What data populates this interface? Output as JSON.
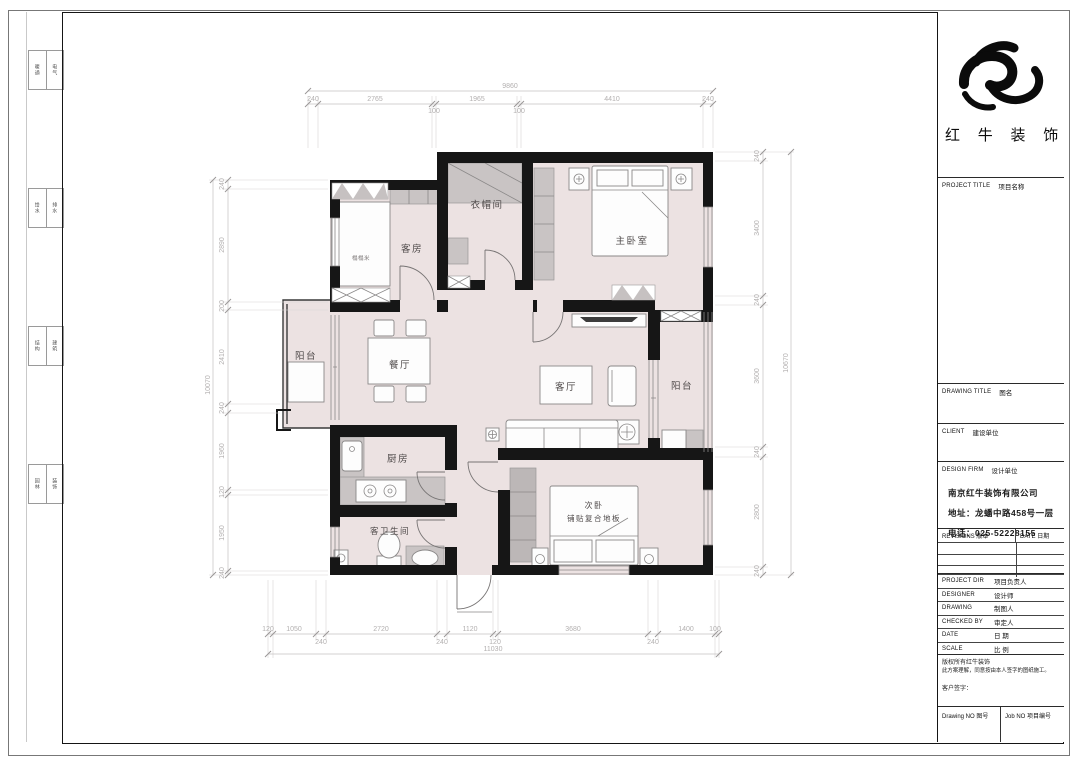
{
  "colors": {
    "wall": "#161616",
    "room_fill": "#ece2e2",
    "furniture_gray": "#c9c4c4",
    "dim_text": "#b3b0b0",
    "frame": "#151515"
  },
  "title_block": {
    "brand": "红 牛 装 饰",
    "sections": {
      "project_title": {
        "en": "PROJECT TITLE",
        "cn": "项目名称"
      },
      "drawing_title": {
        "en": "DRAWING TITLE",
        "cn": "图名"
      },
      "client": {
        "en": "CLIENT",
        "cn": "建设单位"
      },
      "design_firm": {
        "en": "DESIGN FIRM",
        "cn": "设计单位"
      }
    },
    "firm_info": [
      "南京红牛装饰有限公司",
      "地址：龙蟠中路458号一层",
      "电话：025-52228155"
    ],
    "revisions": {
      "left": "REVISIONS 版本",
      "right": "DATE 日期"
    },
    "staff": [
      {
        "en": "PROJECT DIR",
        "cn": "项目负责人"
      },
      {
        "en": "DESIGNER",
        "cn": "设计师"
      },
      {
        "en": "DRAWING",
        "cn": "制图人"
      },
      {
        "en": "CHECKED BY",
        "cn": "审定人"
      },
      {
        "en": "DATE",
        "cn": "日 期"
      },
      {
        "en": "SCALE",
        "cn": "比 例"
      }
    ],
    "copyright": [
      "版权所有红牛装饰",
      "此方案理解，同意按由本人签字的图纸施工。",
      "客户签字："
    ],
    "bottom": {
      "drawing_no": "Drawing NO 图号",
      "job_no": "Job NO 项目编号"
    }
  },
  "signoff_strip": [
    [
      "暖通",
      "电气"
    ],
    [
      "给水",
      "排水"
    ],
    [
      "结构",
      "建筑"
    ],
    [
      "园林",
      "装饰"
    ]
  ],
  "floor_plan": {
    "rooms": {
      "guest": "客房",
      "tatami": "榻榻米",
      "closet": "衣帽间",
      "master": "主卧室",
      "dining": "餐厅",
      "living": "客厅",
      "balcony_left": "阳台",
      "balcony_right": "阳台",
      "kitchen": "厨房",
      "bath": "客卫生间",
      "second": "次卧",
      "second_note": "铺贴复合地板"
    },
    "dimensions": {
      "top": {
        "total": "9860",
        "segments": [
          "240",
          "2765",
          "100",
          "1965",
          "100",
          "4410",
          "240"
        ]
      },
      "bottom": {
        "total": "11030",
        "segments": [
          "120",
          "1050",
          "240",
          "2720",
          "240",
          "1120",
          "120",
          "3680",
          "240",
          "1400",
          "100"
        ]
      },
      "left": {
        "total": "10070",
        "segments": [
          "240",
          "2890",
          "200",
          "2410",
          "240",
          "1960",
          "120",
          "1950",
          "240"
        ]
      },
      "right": {
        "total": "10670",
        "segments": [
          "240",
          "3400",
          "240",
          "3600",
          "240",
          "2800",
          "240"
        ]
      }
    }
  }
}
